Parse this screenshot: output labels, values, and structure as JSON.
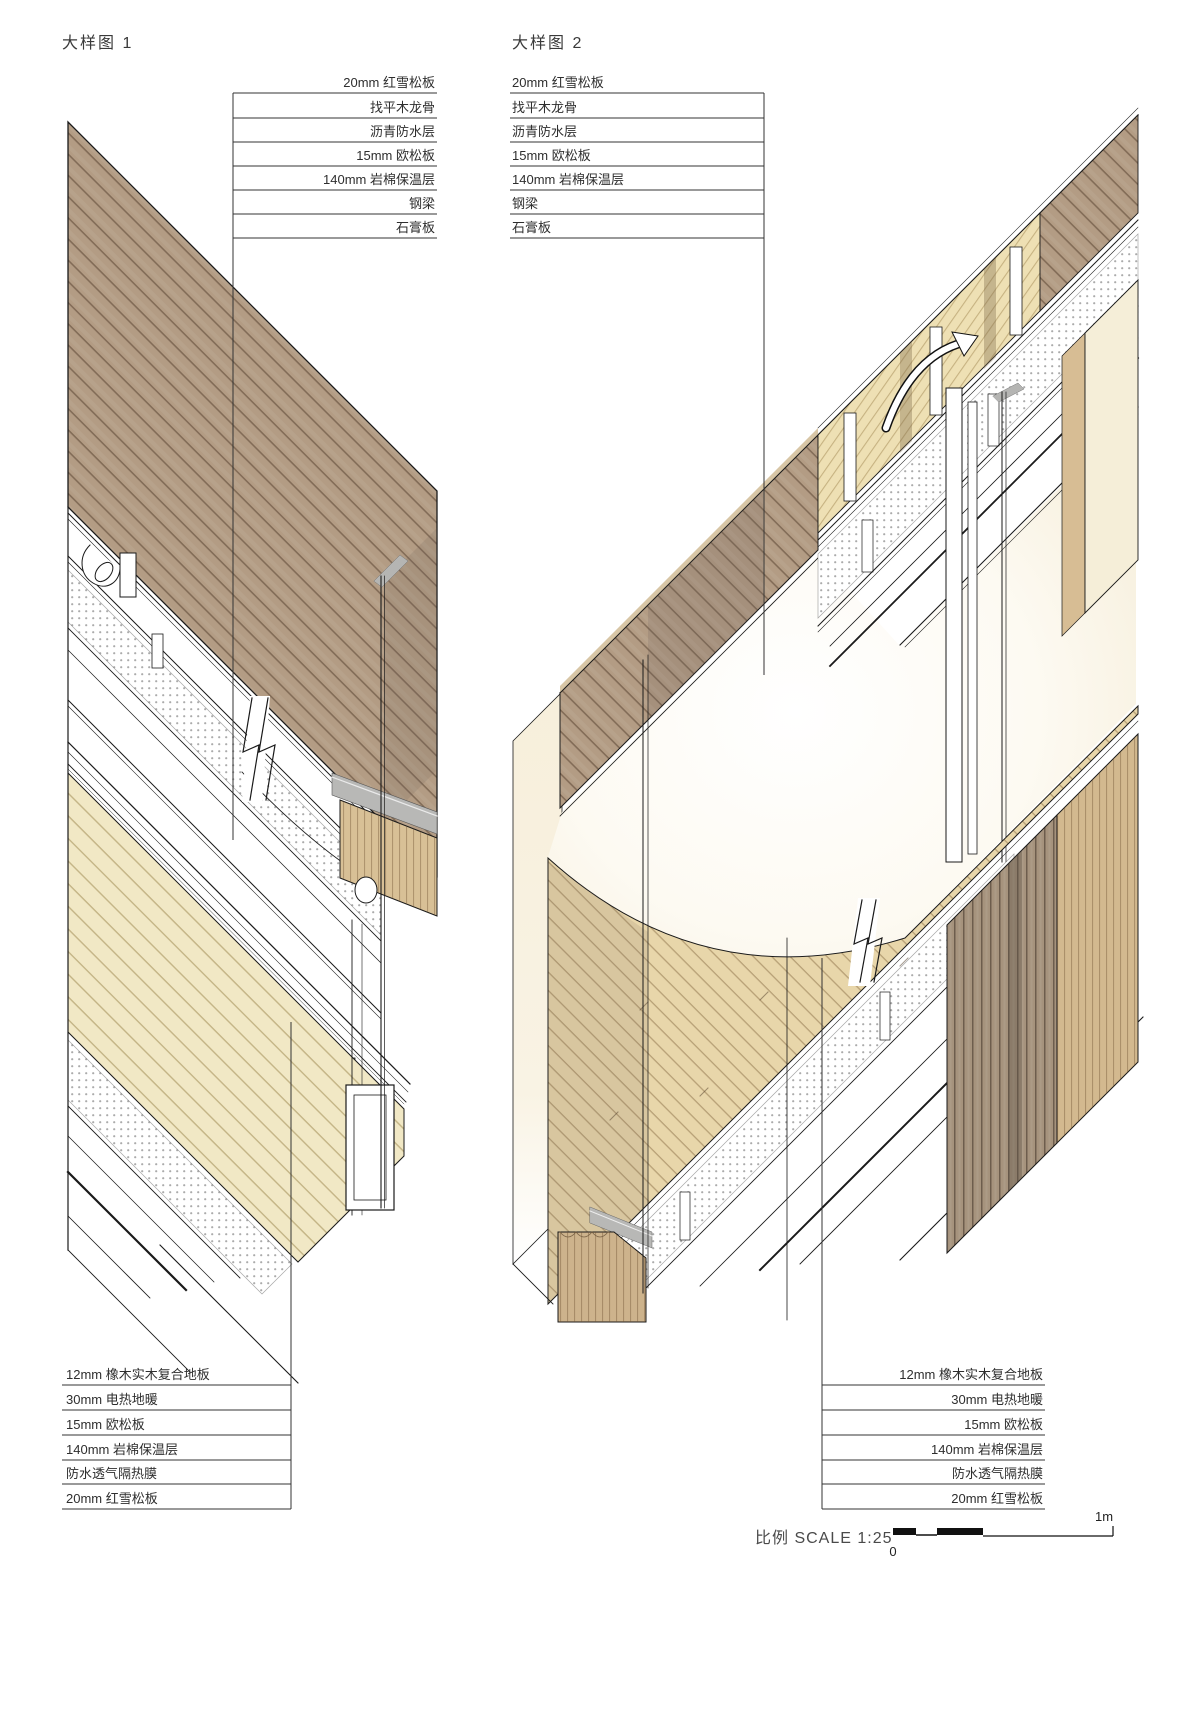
{
  "sheet": {
    "background": "#ffffff",
    "scale_bar": {
      "label": "比例 SCALE 1:25",
      "zero": "0",
      "end": "1m"
    }
  },
  "detail1": {
    "title": "大样图 1",
    "roof_layers": [
      "20mm 红雪松板",
      "找平木龙骨",
      "沥青防水层",
      "15mm 欧松板",
      "140mm 岩棉保温层",
      "钢梁",
      "石膏板"
    ],
    "floor_layers": [
      "12mm 橡木实木复合地板",
      "30mm 电热地暖",
      "15mm 欧松板",
      "140mm 岩棉保温层",
      "防水透气隔热膜",
      "20mm 红雪松板"
    ]
  },
  "detail2": {
    "title": "大样图 2",
    "roof_layers": [
      "20mm 红雪松板",
      "找平木龙骨",
      "沥青防水层",
      "15mm 欧松板",
      "140mm 岩棉保温层",
      "钢梁",
      "石膏板"
    ],
    "floor_layers": [
      "12mm 橡木实木复合地板",
      "30mm 电热地暖",
      "15mm 欧松板",
      "140mm 岩棉保温层",
      "防水透气隔热膜",
      "20mm 红雪松板"
    ]
  },
  "colors": {
    "cedar": "#b39c84",
    "cedar_gap": "#6e5844",
    "floor_tan": "#e8d6aa",
    "osb_cream": "#f1e8c5",
    "joist_cream": "#eee0b4",
    "metal_gray": "#b5b5b3",
    "wall_cream": "#f5edd8",
    "slat_wood": "#a6937d",
    "fascia_tan": "#d3b98f",
    "ink": "#1a1a1a"
  }
}
